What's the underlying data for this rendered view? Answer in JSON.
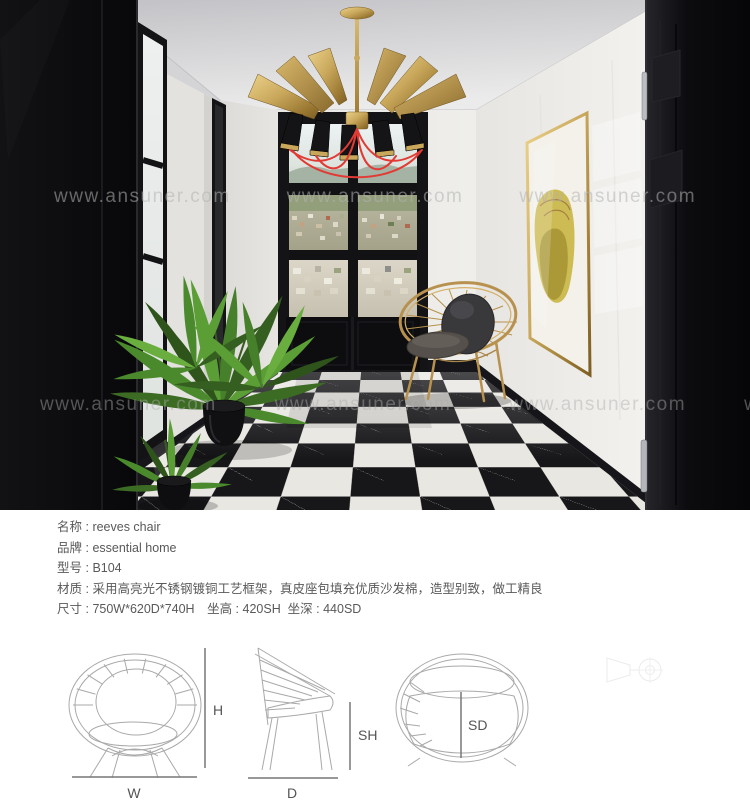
{
  "photo": {
    "watermark": "www.ansuner.com"
  },
  "product_info": {
    "separator": " : ",
    "rows": [
      {
        "label": "名称",
        "value": "reeves chair"
      },
      {
        "label": "品牌",
        "value": "essential home"
      },
      {
        "label": "型号",
        "value": "B104"
      },
      {
        "label": "材质",
        "value": "采用高亮光不锈钢镀铜工艺框架，真皮座包填充优质沙发棉，造型别致，做工精良"
      },
      {
        "label": "尺寸",
        "value": "750W*620D*740H　坐高 : 420SH  坐深 : 440SD"
      }
    ]
  },
  "diagrams": {
    "labels": {
      "width": "W",
      "height": "H",
      "depth": "D",
      "seat_height": "SH",
      "seat_depth": "SD"
    }
  },
  "colors": {
    "brass": "#b7914d",
    "frame_gold": "#c9a85c",
    "cable_red": "#e23a35",
    "door_black": "#0e0e10",
    "marble_white": "#eceae6",
    "floor_black": "#17171a",
    "floor_white": "#e9e7e2",
    "plant_green": "#4e8a2e",
    "cushion_gray": "#55504b"
  }
}
